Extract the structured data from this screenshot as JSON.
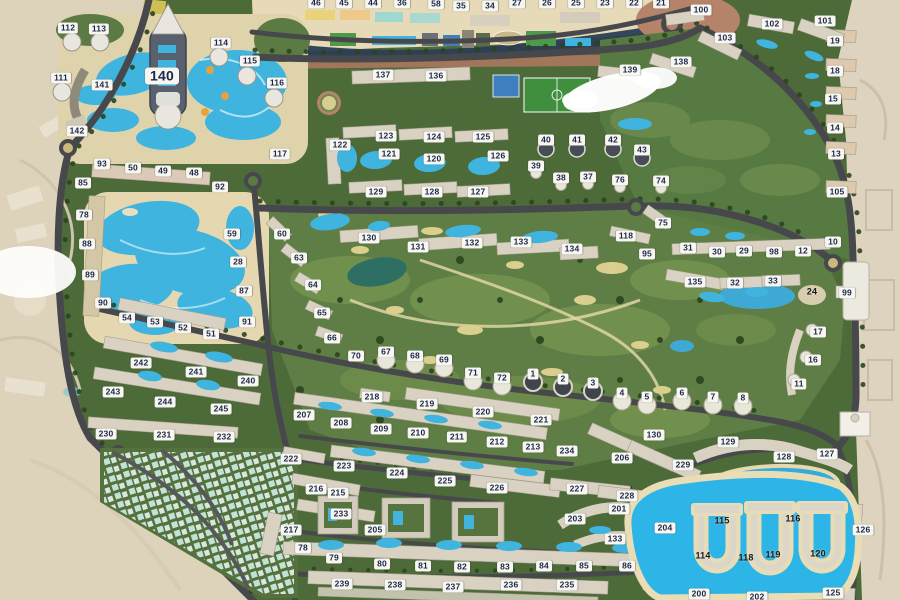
{
  "map": {
    "colors": {
      "green_base": "#4d6a39",
      "green_golf": "#5e7e45",
      "green_light": "#74924e",
      "desert": "#ddd2ba",
      "beach_sand": "#e6dab8",
      "water": "#3fb4de",
      "lagoon": "#2cb5e6",
      "pond_dark": "#2e6e63",
      "road": "#47484c",
      "building": "#d9d2c2",
      "building_sand": "#dcc9ae",
      "tree": "#2c451f",
      "tree_beach": "#2c3e54",
      "label_bg": "#f7f6f1",
      "label_text": "#1a2748"
    },
    "features": [
      "water-park",
      "aqua-park",
      "golf-course",
      "crystal-lagoon",
      "beach-strip",
      "villa-district",
      "desert-surroundings",
      "sports-fields"
    ],
    "labels": [
      {
        "t": "46",
        "x": 316,
        "y": 3
      },
      {
        "t": "45",
        "x": 344,
        "y": 3
      },
      {
        "t": "44",
        "x": 373,
        "y": 3
      },
      {
        "t": "36",
        "x": 402,
        "y": 3
      },
      {
        "t": "58",
        "x": 436,
        "y": 4
      },
      {
        "t": "35",
        "x": 461,
        "y": 6
      },
      {
        "t": "34",
        "x": 490,
        "y": 6
      },
      {
        "t": "27",
        "x": 517,
        "y": 3
      },
      {
        "t": "26",
        "x": 547,
        "y": 3
      },
      {
        "t": "25",
        "x": 576,
        "y": 3
      },
      {
        "t": "23",
        "x": 605,
        "y": 3
      },
      {
        "t": "22",
        "x": 634,
        "y": 3
      },
      {
        "t": "21",
        "x": 661,
        "y": 3
      },
      {
        "t": "112",
        "x": 68,
        "y": 28
      },
      {
        "t": "113",
        "x": 99,
        "y": 29
      },
      {
        "t": "114",
        "x": 221,
        "y": 43
      },
      {
        "t": "115",
        "x": 250,
        "y": 61
      },
      {
        "t": "116",
        "x": 277,
        "y": 83
      },
      {
        "t": "111",
        "x": 61,
        "y": 78
      },
      {
        "t": "140",
        "x": 162,
        "y": 76,
        "v": "big"
      },
      {
        "t": "141",
        "x": 102,
        "y": 85
      },
      {
        "t": "142",
        "x": 77,
        "y": 131
      },
      {
        "t": "117",
        "x": 280,
        "y": 154
      },
      {
        "t": "85",
        "x": 83,
        "y": 183
      },
      {
        "t": "93",
        "x": 102,
        "y": 164
      },
      {
        "t": "50",
        "x": 133,
        "y": 168
      },
      {
        "t": "49",
        "x": 163,
        "y": 171
      },
      {
        "t": "48",
        "x": 194,
        "y": 173
      },
      {
        "t": "92",
        "x": 220,
        "y": 187
      },
      {
        "t": "78",
        "x": 84,
        "y": 215
      },
      {
        "t": "88",
        "x": 87,
        "y": 244
      },
      {
        "t": "89",
        "x": 90,
        "y": 275
      },
      {
        "t": "90",
        "x": 103,
        "y": 303
      },
      {
        "t": "59",
        "x": 232,
        "y": 234
      },
      {
        "t": "28",
        "x": 238,
        "y": 262
      },
      {
        "t": "87",
        "x": 244,
        "y": 291
      },
      {
        "t": "91",
        "x": 247,
        "y": 322
      },
      {
        "t": "60",
        "x": 282,
        "y": 234
      },
      {
        "t": "63",
        "x": 299,
        "y": 258
      },
      {
        "t": "64",
        "x": 313,
        "y": 285
      },
      {
        "t": "65",
        "x": 322,
        "y": 313
      },
      {
        "t": "66",
        "x": 332,
        "y": 338
      },
      {
        "t": "70",
        "x": 356,
        "y": 356
      },
      {
        "t": "54",
        "x": 127,
        "y": 318
      },
      {
        "t": "53",
        "x": 155,
        "y": 322
      },
      {
        "t": "52",
        "x": 183,
        "y": 328
      },
      {
        "t": "51",
        "x": 211,
        "y": 334
      },
      {
        "t": "242",
        "x": 141,
        "y": 363
      },
      {
        "t": "241",
        "x": 196,
        "y": 372
      },
      {
        "t": "240",
        "x": 248,
        "y": 381
      },
      {
        "t": "243",
        "x": 113,
        "y": 392
      },
      {
        "t": "244",
        "x": 165,
        "y": 402
      },
      {
        "t": "245",
        "x": 221,
        "y": 409
      },
      {
        "t": "230",
        "x": 106,
        "y": 434
      },
      {
        "t": "231",
        "x": 164,
        "y": 435
      },
      {
        "t": "232",
        "x": 224,
        "y": 437
      },
      {
        "t": "222",
        "x": 291,
        "y": 459
      },
      {
        "t": "217",
        "x": 291,
        "y": 530
      },
      {
        "t": "137",
        "x": 383,
        "y": 75
      },
      {
        "t": "136",
        "x": 436,
        "y": 76
      },
      {
        "t": "123",
        "x": 386,
        "y": 136
      },
      {
        "t": "124",
        "x": 434,
        "y": 137
      },
      {
        "t": "125",
        "x": 483,
        "y": 137
      },
      {
        "t": "122",
        "x": 340,
        "y": 145
      },
      {
        "t": "121",
        "x": 389,
        "y": 154
      },
      {
        "t": "120",
        "x": 434,
        "y": 159
      },
      {
        "t": "126",
        "x": 498,
        "y": 156
      },
      {
        "t": "129",
        "x": 376,
        "y": 192
      },
      {
        "t": "128",
        "x": 432,
        "y": 192
      },
      {
        "t": "127",
        "x": 478,
        "y": 192
      },
      {
        "t": "40",
        "x": 546,
        "y": 140
      },
      {
        "t": "41",
        "x": 577,
        "y": 140
      },
      {
        "t": "42",
        "x": 613,
        "y": 140
      },
      {
        "t": "43",
        "x": 642,
        "y": 150
      },
      {
        "t": "39",
        "x": 536,
        "y": 166
      },
      {
        "t": "38",
        "x": 561,
        "y": 178
      },
      {
        "t": "37",
        "x": 588,
        "y": 177
      },
      {
        "t": "76",
        "x": 620,
        "y": 180
      },
      {
        "t": "74",
        "x": 661,
        "y": 181
      },
      {
        "t": "75",
        "x": 663,
        "y": 223
      },
      {
        "t": "100",
        "x": 701,
        "y": 10
      },
      {
        "t": "102",
        "x": 772,
        "y": 24
      },
      {
        "t": "101",
        "x": 825,
        "y": 21
      },
      {
        "t": "103",
        "x": 725,
        "y": 38
      },
      {
        "t": "139",
        "x": 630,
        "y": 70
      },
      {
        "t": "138",
        "x": 681,
        "y": 62
      },
      {
        "t": "19",
        "x": 835,
        "y": 41
      },
      {
        "t": "18",
        "x": 835,
        "y": 71
      },
      {
        "t": "15",
        "x": 833,
        "y": 99
      },
      {
        "t": "14",
        "x": 835,
        "y": 128
      },
      {
        "t": "13",
        "x": 836,
        "y": 154
      },
      {
        "t": "105",
        "x": 837,
        "y": 192
      },
      {
        "t": "130",
        "x": 369,
        "y": 238
      },
      {
        "t": "131",
        "x": 418,
        "y": 247
      },
      {
        "t": "132",
        "x": 472,
        "y": 243
      },
      {
        "t": "133",
        "x": 521,
        "y": 242
      },
      {
        "t": "134",
        "x": 572,
        "y": 249
      },
      {
        "t": "118",
        "x": 626,
        "y": 236
      },
      {
        "t": "95",
        "x": 647,
        "y": 254
      },
      {
        "t": "31",
        "x": 688,
        "y": 248
      },
      {
        "t": "30",
        "x": 717,
        "y": 252
      },
      {
        "t": "29",
        "x": 744,
        "y": 251
      },
      {
        "t": "98",
        "x": 774,
        "y": 252
      },
      {
        "t": "12",
        "x": 803,
        "y": 251
      },
      {
        "t": "10",
        "x": 833,
        "y": 242
      },
      {
        "t": "135",
        "x": 695,
        "y": 282
      },
      {
        "t": "32",
        "x": 735,
        "y": 283
      },
      {
        "t": "33",
        "x": 773,
        "y": 281
      },
      {
        "t": "24",
        "x": 812,
        "y": 292,
        "v": "dark"
      },
      {
        "t": "99",
        "x": 847,
        "y": 293
      },
      {
        "t": "17",
        "x": 818,
        "y": 332
      },
      {
        "t": "16",
        "x": 813,
        "y": 360
      },
      {
        "t": "11",
        "x": 799,
        "y": 384
      },
      {
        "t": "67",
        "x": 386,
        "y": 352
      },
      {
        "t": "68",
        "x": 415,
        "y": 356
      },
      {
        "t": "69",
        "x": 444,
        "y": 360
      },
      {
        "t": "71",
        "x": 473,
        "y": 373
      },
      {
        "t": "72",
        "x": 502,
        "y": 378
      },
      {
        "t": "1",
        "x": 533,
        "y": 374
      },
      {
        "t": "2",
        "x": 563,
        "y": 379
      },
      {
        "t": "3",
        "x": 593,
        "y": 383
      },
      {
        "t": "4",
        "x": 622,
        "y": 393
      },
      {
        "t": "5",
        "x": 647,
        "y": 397
      },
      {
        "t": "6",
        "x": 682,
        "y": 393
      },
      {
        "t": "7",
        "x": 713,
        "y": 397
      },
      {
        "t": "8",
        "x": 743,
        "y": 398
      },
      {
        "t": "218",
        "x": 372,
        "y": 397
      },
      {
        "t": "219",
        "x": 427,
        "y": 404
      },
      {
        "t": "220",
        "x": 483,
        "y": 412
      },
      {
        "t": "221",
        "x": 541,
        "y": 420
      },
      {
        "t": "207",
        "x": 304,
        "y": 415
      },
      {
        "t": "208",
        "x": 341,
        "y": 423
      },
      {
        "t": "209",
        "x": 381,
        "y": 429
      },
      {
        "t": "210",
        "x": 418,
        "y": 433
      },
      {
        "t": "211",
        "x": 457,
        "y": 437
      },
      {
        "t": "212",
        "x": 497,
        "y": 442
      },
      {
        "t": "213",
        "x": 533,
        "y": 447
      },
      {
        "t": "234",
        "x": 567,
        "y": 451
      },
      {
        "t": "223",
        "x": 344,
        "y": 466
      },
      {
        "t": "224",
        "x": 397,
        "y": 473
      },
      {
        "t": "225",
        "x": 445,
        "y": 481
      },
      {
        "t": "226",
        "x": 497,
        "y": 488
      },
      {
        "t": "227",
        "x": 577,
        "y": 489
      },
      {
        "t": "228",
        "x": 627,
        "y": 496
      },
      {
        "t": "216",
        "x": 316,
        "y": 489
      },
      {
        "t": "215",
        "x": 338,
        "y": 493
      },
      {
        "t": "233",
        "x": 341,
        "y": 514
      },
      {
        "t": "205",
        "x": 375,
        "y": 530
      },
      {
        "t": "78",
        "x": 303,
        "y": 548
      },
      {
        "t": "79",
        "x": 334,
        "y": 558
      },
      {
        "t": "80",
        "x": 382,
        "y": 564
      },
      {
        "t": "81",
        "x": 423,
        "y": 566
      },
      {
        "t": "82",
        "x": 462,
        "y": 567
      },
      {
        "t": "83",
        "x": 505,
        "y": 567
      },
      {
        "t": "84",
        "x": 544,
        "y": 566
      },
      {
        "t": "85",
        "x": 584,
        "y": 566
      },
      {
        "t": "86",
        "x": 627,
        "y": 566
      },
      {
        "t": "239",
        "x": 342,
        "y": 584
      },
      {
        "t": "238",
        "x": 395,
        "y": 585
      },
      {
        "t": "237",
        "x": 453,
        "y": 587
      },
      {
        "t": "236",
        "x": 511,
        "y": 585
      },
      {
        "t": "235",
        "x": 567,
        "y": 585
      },
      {
        "t": "130",
        "x": 654,
        "y": 435
      },
      {
        "t": "206",
        "x": 622,
        "y": 458
      },
      {
        "t": "229",
        "x": 683,
        "y": 465
      },
      {
        "t": "129",
        "x": 728,
        "y": 442
      },
      {
        "t": "128",
        "x": 784,
        "y": 457
      },
      {
        "t": "127",
        "x": 827,
        "y": 454
      },
      {
        "t": "126",
        "x": 863,
        "y": 530
      },
      {
        "t": "201",
        "x": 619,
        "y": 509
      },
      {
        "t": "203",
        "x": 575,
        "y": 519
      },
      {
        "t": "133",
        "x": 615,
        "y": 539
      },
      {
        "t": "204",
        "x": 665,
        "y": 528
      },
      {
        "t": "200",
        "x": 699,
        "y": 594
      },
      {
        "t": "202",
        "x": 757,
        "y": 597
      },
      {
        "t": "125",
        "x": 833,
        "y": 593
      },
      {
        "t": "115",
        "x": 722,
        "y": 521,
        "v": "dark"
      },
      {
        "t": "116",
        "x": 793,
        "y": 519,
        "v": "dark"
      },
      {
        "t": "114",
        "x": 703,
        "y": 556,
        "v": "dark"
      },
      {
        "t": "118",
        "x": 746,
        "y": 558,
        "v": "dark"
      },
      {
        "t": "119",
        "x": 773,
        "y": 555,
        "v": "dark"
      },
      {
        "t": "120",
        "x": 818,
        "y": 554,
        "v": "dark"
      }
    ]
  }
}
